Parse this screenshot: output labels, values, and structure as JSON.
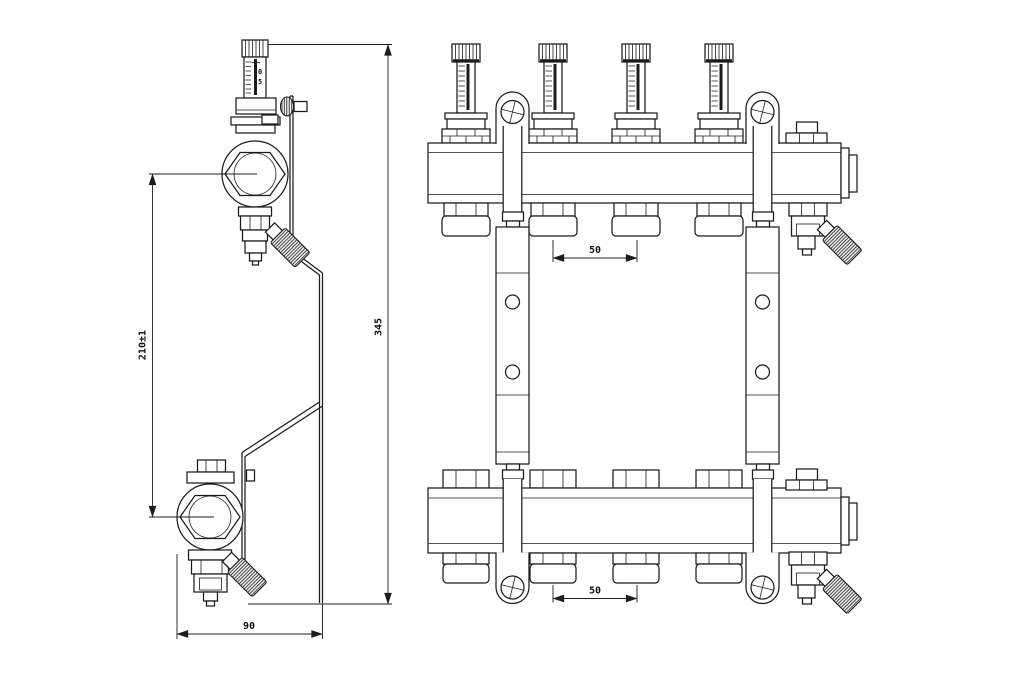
{
  "drawing": {
    "background": "#ffffff",
    "line_color": "#1c1c1c",
    "dimensions": {
      "valve_center_spacing": "210±1",
      "overall_height": "345",
      "bracket_depth": "90",
      "top_manifold_outlet_spacing": "50",
      "bottom_manifold_outlet_spacing": "50"
    },
    "flow_meter_scale": {
      "top": "0",
      "bottom": "5"
    }
  }
}
